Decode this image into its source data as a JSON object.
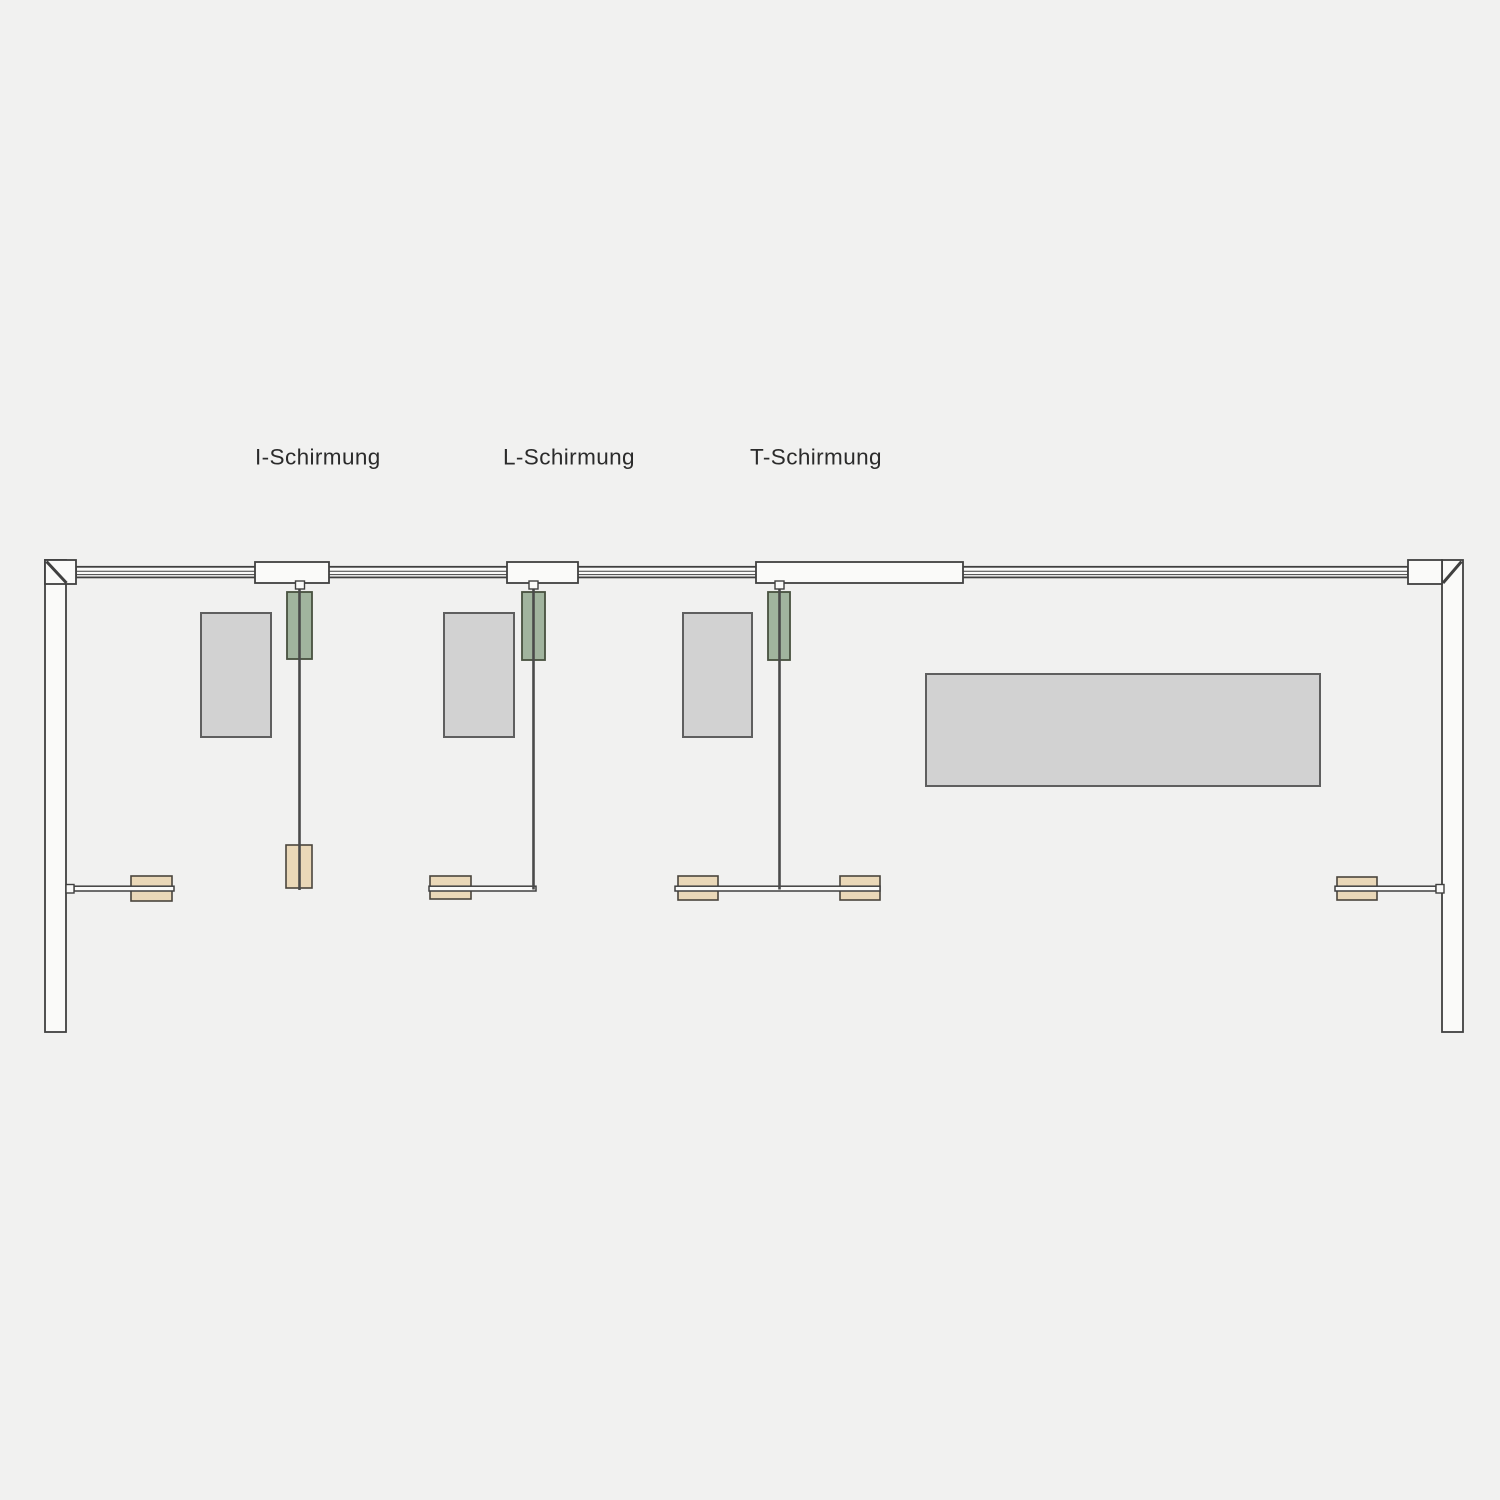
{
  "diagram": {
    "description": "Plan view of a rail-mounted screen shielding system with three variants",
    "labels": {
      "i_schirmung": "I-Schirmung",
      "l_schirmung": "L-Schirmung",
      "t_schirmung": "T-Schirmung"
    }
  },
  "colors": {
    "bg": "#f1f1f0",
    "white": "#fafaf9",
    "stroke": "#404040",
    "cable": "#4a4a4a",
    "panelFill": "#d2d2d2",
    "panelStroke": "#5f5f5f",
    "greenFill": "#a1b49e",
    "greenStroke": "#47503f",
    "tanFill": "#ead8b8",
    "tanStroke": "#4a453c",
    "text": "#2b2b2b"
  }
}
